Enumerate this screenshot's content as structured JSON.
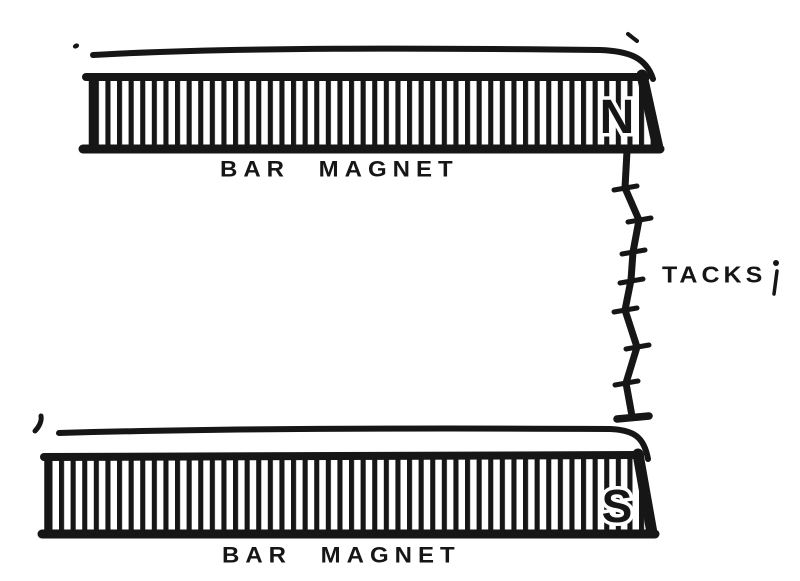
{
  "figure": {
    "background_color": "#ffffff",
    "ink_color": "#161616",
    "top_magnet": {
      "caption": "BAR MAGNET",
      "pole_label": "N"
    },
    "bottom_magnet": {
      "caption": "BAR MAGNET",
      "pole_label": "S"
    },
    "tacks": {
      "caption": "TACKS",
      "tack_count": 7
    }
  }
}
